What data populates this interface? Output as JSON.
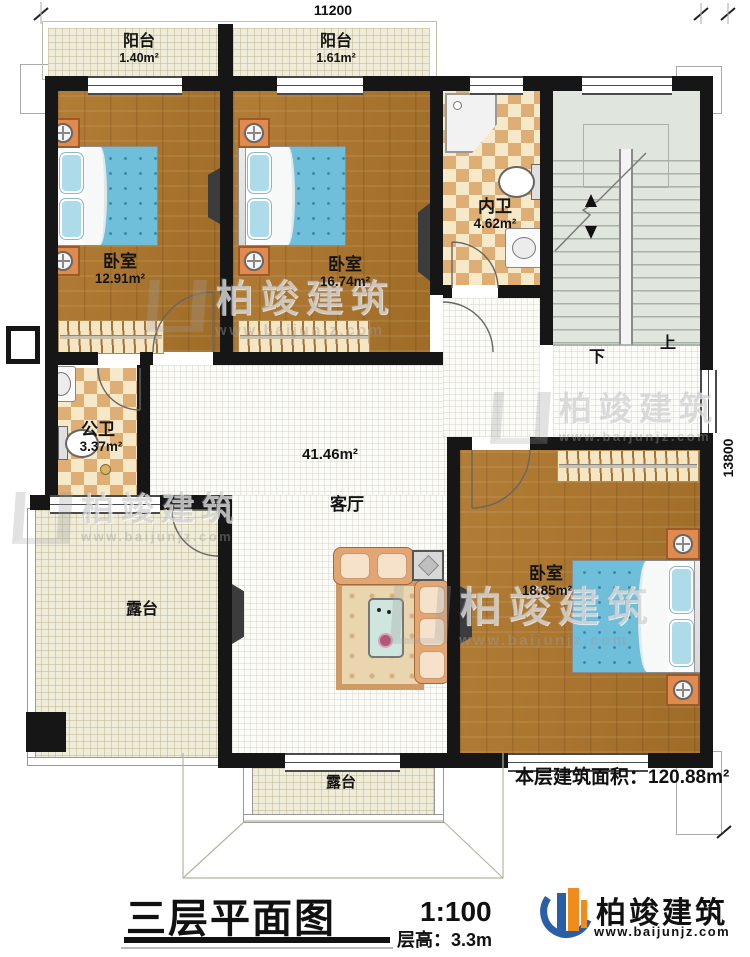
{
  "plan": {
    "dimensions": {
      "width_top": "11200",
      "height_right": "13800"
    },
    "rooms": {
      "balcony1": {
        "name": "阳台",
        "area": "1.40m²"
      },
      "balcony2": {
        "name": "阳台",
        "area": "1.61m²"
      },
      "bedroom1": {
        "name": "卧室",
        "area": "12.91m²"
      },
      "bedroom2": {
        "name": "卧室",
        "area": "16.74m²"
      },
      "inner_bath": {
        "name": "内卫",
        "area": "4.62m²"
      },
      "public_bath": {
        "name": "公卫",
        "area": "3.37m²"
      },
      "living": {
        "name": "客厅",
        "area": "41.46m²"
      },
      "bedroom3": {
        "name": "卧室",
        "area": "18.85m²"
      },
      "terrace_left": {
        "name": "露台"
      },
      "terrace_bottom": {
        "name": "露台"
      }
    },
    "stairs": {
      "up": "上",
      "down": "下"
    }
  },
  "footer": {
    "floor_area_label": "本层建筑面积：",
    "floor_area_value": "120.88m²",
    "title": "三层平面图",
    "scale": "1:100",
    "floor_height_label": "层高：",
    "floor_height_value": "3.3m"
  },
  "brand": {
    "name": "柏竣建筑",
    "url": "www.baijunjz.com",
    "blue": "#2a5fa8",
    "orange": "#f08c1e"
  },
  "watermark": {
    "name": "柏竣建筑",
    "url": "www.baijunjz.com"
  }
}
